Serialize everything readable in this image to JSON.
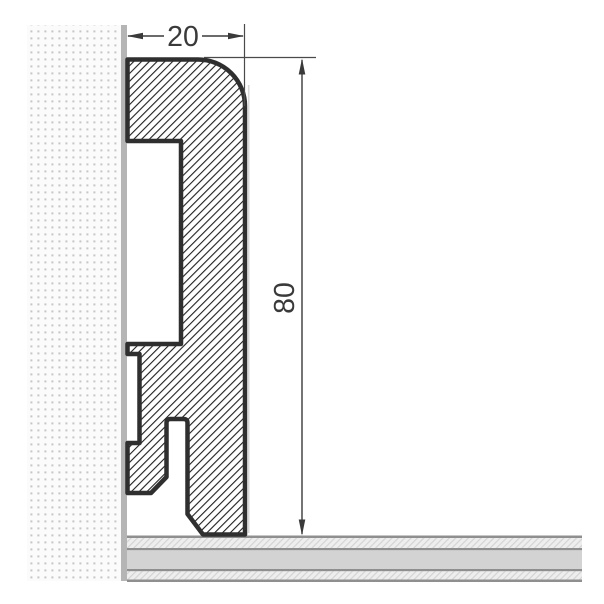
{
  "drawing": {
    "title": "Skirting board profile cross-section",
    "dimension_width": {
      "value": "20"
    },
    "dimension_height": {
      "value": "80"
    }
  },
  "colors": {
    "page_background": "#ffffff",
    "outline": "#2f2f2f",
    "hatch_line": "#1f1f1f",
    "profile_fill": "#ffffff",
    "edge_shadow": "#d8d8d8",
    "dimension_line": "#3a3a3a",
    "dimension_text": "#3a3a3a",
    "extension_line": "#4a4a4a",
    "wall_surface": "#b5b5b5",
    "wall_dots": "#c6c6c6",
    "wall_background": "#fbfbfb",
    "floor_border": "#8f8f8f",
    "floor_solid": "#d3d3d3",
    "floor_hatch_background": "#eeeeee",
    "floor_hatch_line": "#d4d4d4"
  }
}
